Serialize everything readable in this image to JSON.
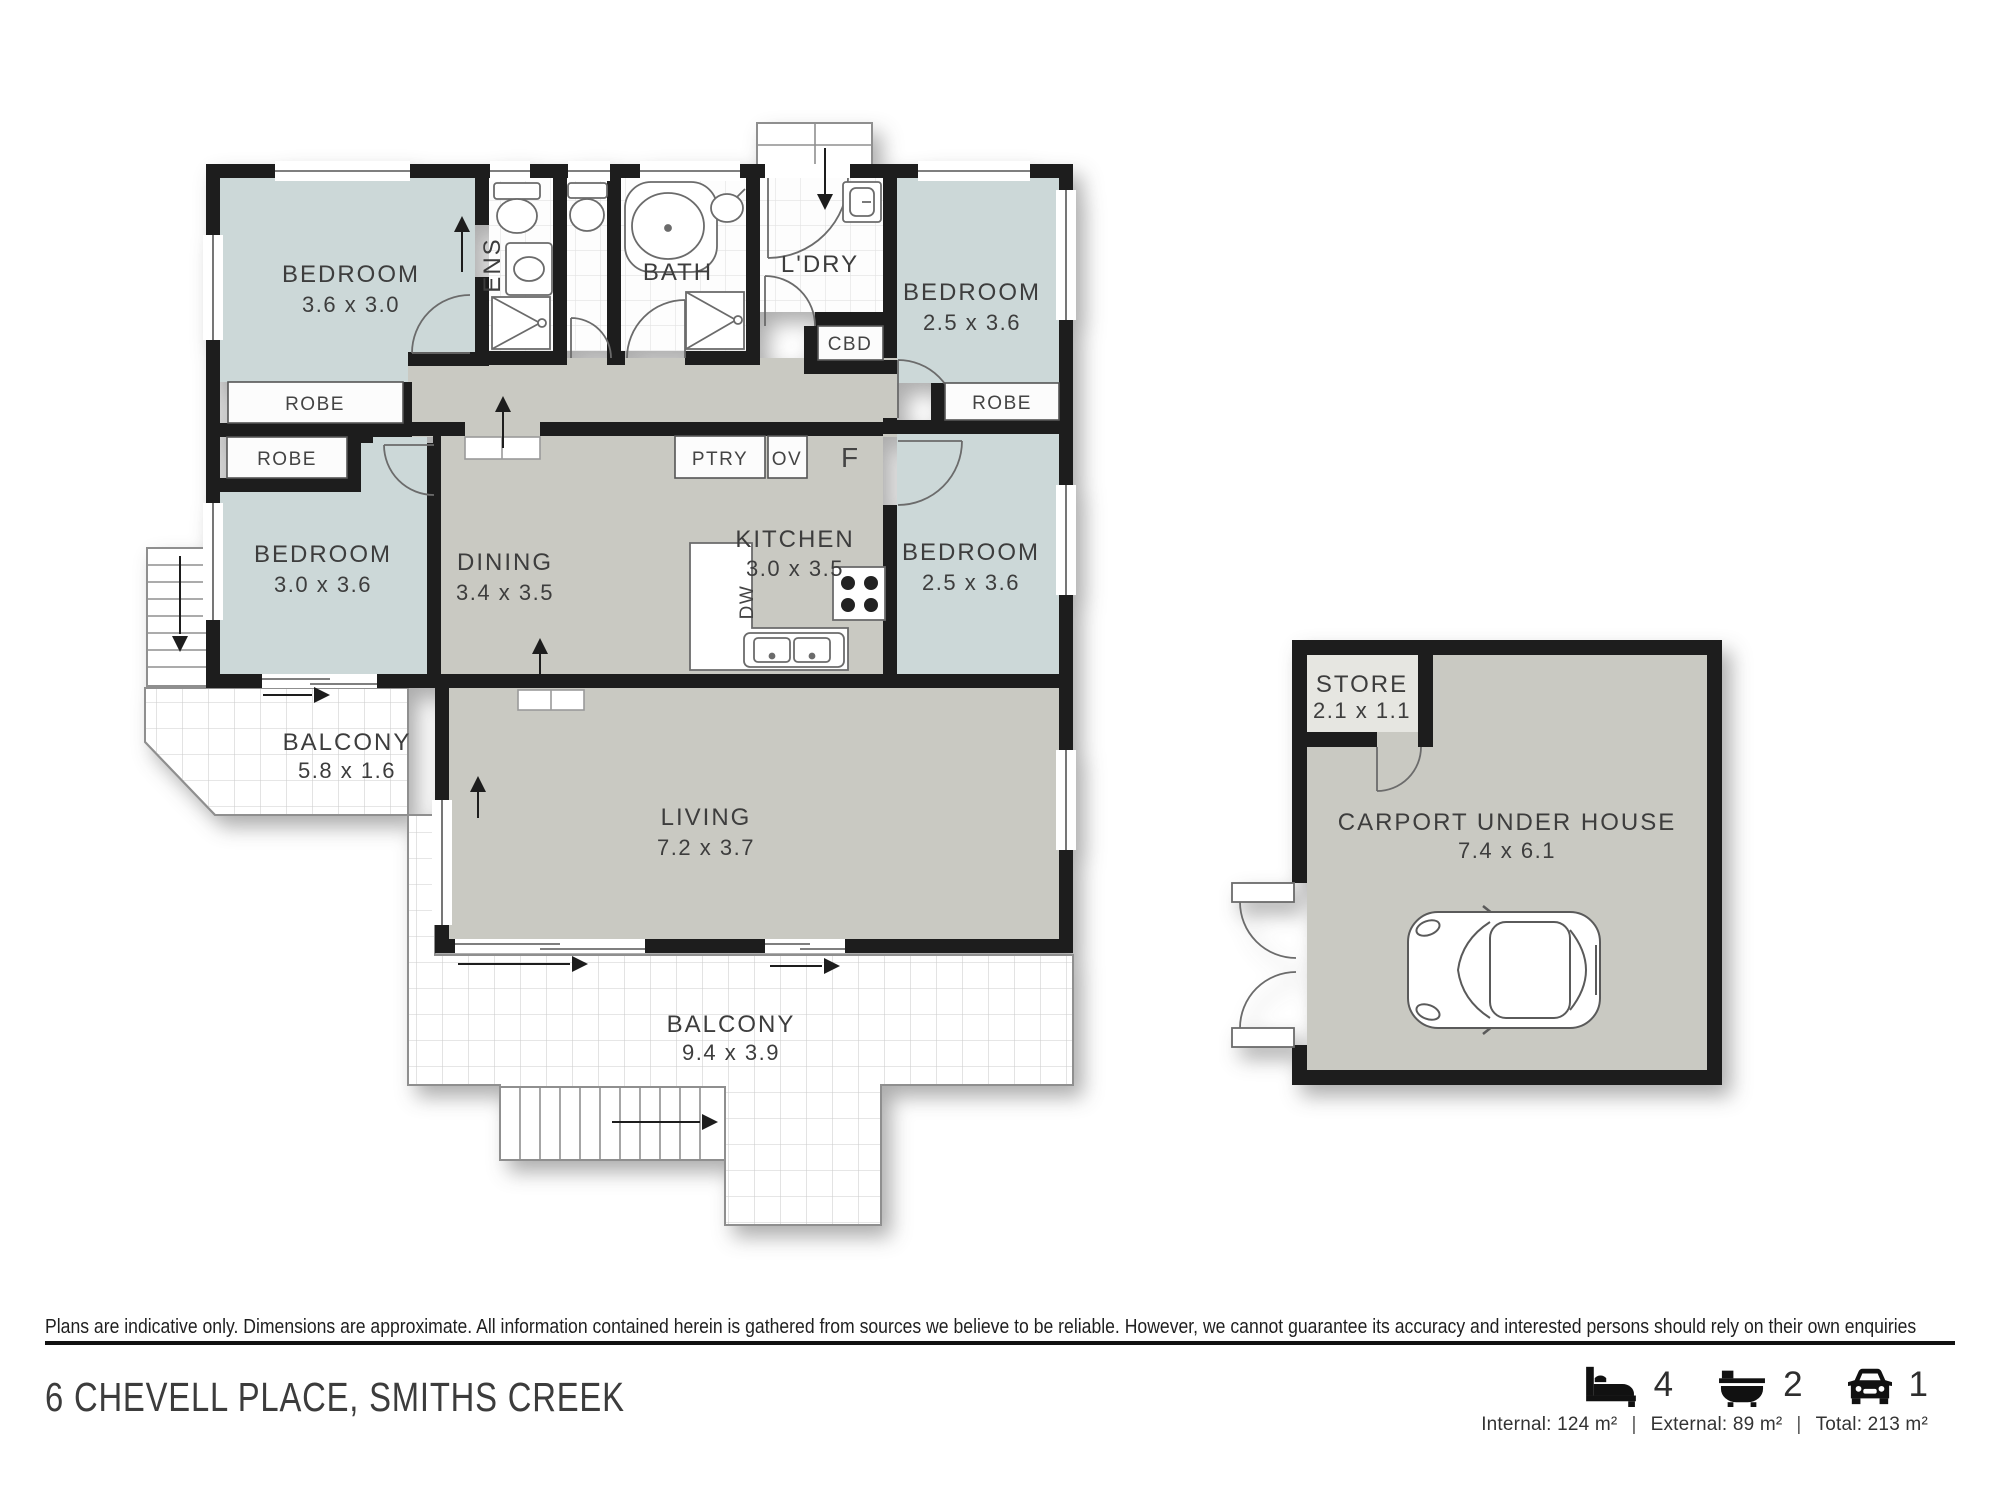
{
  "plan": {
    "rooms": {
      "bedroom1": {
        "name": "BEDROOM",
        "dims": "3.6 x 3.0"
      },
      "bedroom2": {
        "name": "BEDROOM",
        "dims": "2.5 x 3.6"
      },
      "bedroom3": {
        "name": "BEDROOM",
        "dims": "3.0 x 3.6"
      },
      "bedroom4": {
        "name": "BEDROOM",
        "dims": "2.5 x 3.6"
      },
      "dining": {
        "name": "DINING",
        "dims": "3.4 x 3.5"
      },
      "kitchen": {
        "name": "KITCHEN",
        "dims": "3.0 x 3.5"
      },
      "living": {
        "name": "LIVING",
        "dims": "7.2 x 3.7"
      },
      "bath": {
        "name": "BATH"
      },
      "ens": {
        "name": "ENS"
      },
      "ldry": {
        "name": "L'DRY"
      },
      "balcony_upper": {
        "name": "BALCONY",
        "dims": "5.8 x 1.6"
      },
      "balcony_lower": {
        "name": "BALCONY",
        "dims": "9.4 x 3.9"
      },
      "store": {
        "name": "STORE",
        "dims": "2.1 x 1.1"
      },
      "carport": {
        "name": "CARPORT UNDER HOUSE",
        "dims": "7.4 x 6.1"
      }
    },
    "labels": {
      "robe": "ROBE",
      "ptry": "PTRY",
      "ov": "OV",
      "cbd": "CBD",
      "fridge": "F",
      "dw": "DW"
    }
  },
  "footer": {
    "disclaimer": "Plans are indicative only. Dimensions are approximate. All information contained herein is gathered from sources we believe to be reliable. However, we cannot guarantee its accuracy and interested persons should rely on their own enquiries",
    "address": "6 CHEVELL PLACE, SMITHS CREEK",
    "stats": {
      "beds": "4",
      "baths": "2",
      "cars": "1"
    },
    "areas": {
      "internal": "Internal: 124 m²",
      "external": "External: 89 m²",
      "total": "Total: 213 m²"
    },
    "separator": "|"
  },
  "colors": {
    "wall": "#1d1d1d",
    "bedroom_fill": "#ccd8d8",
    "floor_fill": "#c9c9c2",
    "label_text": "#3d3d3d",
    "accent_black": "#111111"
  }
}
